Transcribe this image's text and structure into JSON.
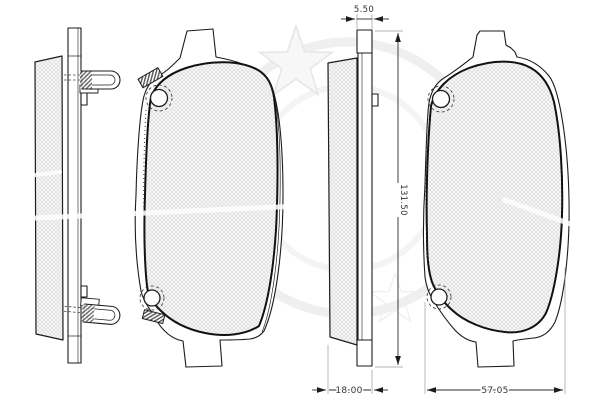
{
  "drawing": {
    "kind": "disc-brake-pad-set-technical-drawing",
    "dimension_labels": {
      "backplate_thickness": "5.50",
      "pad_height": "131.50",
      "pad_total_thickness": "18.00",
      "pad_bottom_width": "57.05"
    },
    "colors": {
      "background": "#ffffff",
      "outline": "#1c1c1c",
      "friction_outline": "#111111",
      "hatch_line": "#c9c9c9",
      "hatch_fill": "#f6f6f6",
      "dimension_line": "#2b2b2b",
      "extension_line": "#9a9a9a",
      "watermark": "#ececec"
    }
  }
}
